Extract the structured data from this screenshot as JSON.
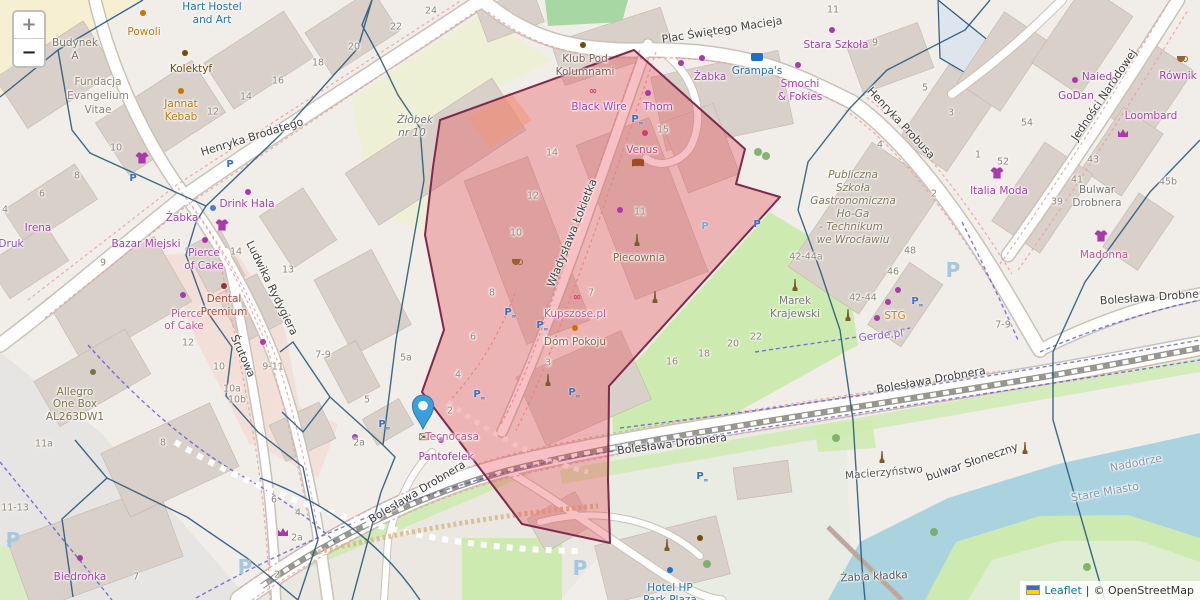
{
  "controls": {
    "zoom_in": "+",
    "zoom_out": "−"
  },
  "attribution": {
    "leaflet": "Leaflet",
    "separator": "|",
    "osm": "© OpenStreetMap"
  },
  "overlay": {
    "fill": "rgba(229,58,70,0.32)",
    "stroke": "#7e2a4d"
  },
  "marker": {
    "x": 423,
    "y": 434
  },
  "map_labels": [
    {
      "t": "Henryka Brodatego",
      "x": 252,
      "y": 137,
      "r": -17,
      "c": "#3f3f3f",
      "s": 11
    },
    {
      "t": "Plac Świętego Macieja",
      "x": 722,
      "y": 30,
      "r": -9,
      "c": "#3f3f3f",
      "s": 11
    },
    {
      "t": "Henryka Probusa",
      "x": 901,
      "y": 123,
      "r": 47,
      "c": "#3f3f3f",
      "s": 11
    },
    {
      "t": "Jedności Narodowej",
      "x": 1104,
      "y": 95,
      "r": -56,
      "c": "#3f3f3f",
      "s": 11
    },
    {
      "t": "Ludwika Rydygiera",
      "x": 272,
      "y": 288,
      "r": 64,
      "c": "#3f3f3f",
      "s": 11
    },
    {
      "t": "Śrutowa",
      "x": 243,
      "y": 356,
      "r": 66,
      "c": "#3f3f3f",
      "s": 11
    },
    {
      "t": "Władysława Łokietka",
      "x": 572,
      "y": 233,
      "r": -68,
      "c": "#3f3f3f",
      "s": 11
    },
    {
      "t": "Bolesława Drobnera",
      "x": 417,
      "y": 492,
      "r": -31,
      "c": "#3f3f3f",
      "s": 11
    },
    {
      "t": "Bolesława Drobnera",
      "x": 672,
      "y": 444,
      "r": -7,
      "c": "#3f3f3f",
      "s": 11
    },
    {
      "t": "Bolesława Drobnera",
      "x": 931,
      "y": 380,
      "r": -10,
      "c": "#3f3f3f",
      "s": 11
    },
    {
      "t": "Bolesława Drobnera",
      "x": 1155,
      "y": 297,
      "r": -4,
      "c": "#3f3f3f",
      "s": 11
    },
    {
      "t": "bulwar Słoneczny",
      "x": 972,
      "y": 462,
      "r": -19,
      "c": "#3f3f3f",
      "s": 11
    },
    {
      "t": "Żabia kładka",
      "x": 874,
      "y": 577,
      "r": -3,
      "c": "#555555",
      "s": 10.5
    },
    {
      "t": "Nadodrze",
      "x": 1136,
      "y": 463,
      "r": -11,
      "c": "#8795a8",
      "s": 11
    },
    {
      "t": "Stare Miasto",
      "x": 1105,
      "y": 492,
      "r": -10,
      "c": "#8795a8",
      "s": 11
    },
    {
      "t": "Macierzyństwo",
      "x": 884,
      "y": 473,
      "r": -5,
      "c": "#555555",
      "s": 10.5
    },
    {
      "t": "Budynek",
      "x": 75,
      "y": 43,
      "c": "#7a7467"
    },
    {
      "t": "A",
      "x": 75,
      "y": 56,
      "c": "#7a7467"
    },
    {
      "t": "Fundacja",
      "x": 98,
      "y": 82,
      "c": "#8c8370"
    },
    {
      "t": "Evangelium",
      "x": 98,
      "y": 96,
      "c": "#8c8370"
    },
    {
      "t": "Vitae",
      "x": 98,
      "y": 110,
      "c": "#8c8370"
    },
    {
      "t": "Hart Hostel",
      "x": 212,
      "y": 7,
      "c": "#1d70c6"
    },
    {
      "t": "and Art",
      "x": 212,
      "y": 20,
      "c": "#1d70c6"
    },
    {
      "t": "Żłobek",
      "x": 415,
      "y": 120,
      "c": "#777777",
      "i": true
    },
    {
      "t": "nr 10",
      "x": 412,
      "y": 133,
      "c": "#777777",
      "i": true
    },
    {
      "t": "Klub Pod",
      "x": 585,
      "y": 59,
      "c": "#7d6052"
    },
    {
      "t": "Kolumnami",
      "x": 585,
      "y": 72,
      "c": "#7d6052"
    },
    {
      "t": "Publiczna",
      "x": 853,
      "y": 175,
      "c": "#7e7a58",
      "i": true
    },
    {
      "t": "Szkoła",
      "x": 853,
      "y": 188,
      "c": "#7e7a58",
      "i": true
    },
    {
      "t": "Gastronomiczna",
      "x": 853,
      "y": 201,
      "c": "#7e7a58",
      "i": true
    },
    {
      "t": "Ho-Ga",
      "x": 853,
      "y": 214,
      "c": "#7e7a58",
      "i": true
    },
    {
      "t": "- Technikum",
      "x": 851,
      "y": 227,
      "c": "#7e7a58",
      "i": true
    },
    {
      "t": "we Wrocławiu",
      "x": 853,
      "y": 240,
      "c": "#7e7a58",
      "i": true
    },
    {
      "t": "Marek",
      "x": 795,
      "y": 301,
      "c": "#777777"
    },
    {
      "t": "Krajewski",
      "x": 795,
      "y": 314,
      "c": "#777777"
    },
    {
      "t": "Bulwar",
      "x": 1097,
      "y": 190,
      "c": "#777777"
    },
    {
      "t": "Drobnera",
      "x": 1097,
      "y": 203,
      "c": "#777777"
    },
    {
      "t": "Hotel HP",
      "x": 670,
      "y": 588,
      "c": "#1d70c6"
    },
    {
      "t": "Park Plaza",
      "x": 670,
      "y": 600,
      "c": "#1d70c6"
    },
    {
      "t": "Powoli",
      "x": 144,
      "y": 32,
      "c": "#c77400"
    },
    {
      "t": "Kolektyf",
      "x": 191,
      "y": 69,
      "c": "#734a08"
    },
    {
      "t": "Jannat",
      "x": 181,
      "y": 104,
      "c": "#c77400"
    },
    {
      "t": "Kebab",
      "x": 181,
      "y": 117,
      "c": "#c77400"
    },
    {
      "t": "Irena",
      "x": 38,
      "y": 228,
      "c": "#ac39ac"
    },
    {
      "t": "Druk",
      "x": 11,
      "y": 244,
      "c": "#8a4fc8"
    },
    {
      "t": "Żabka",
      "x": 182,
      "y": 218,
      "c": "#ac39ac"
    },
    {
      "t": "Żabka",
      "x": 710,
      "y": 77,
      "c": "#ac39ac"
    },
    {
      "t": "Bazar Miejski",
      "x": 146,
      "y": 244,
      "c": "#ac39ac"
    },
    {
      "t": "Drink Hala",
      "x": 247,
      "y": 204,
      "c": "#ac39ac"
    },
    {
      "t": "Pierce",
      "x": 204,
      "y": 253,
      "c": "#ac39ac"
    },
    {
      "t": "of Cake",
      "x": 204,
      "y": 266,
      "c": "#ac39ac"
    },
    {
      "t": "Pierce",
      "x": 187,
      "y": 314,
      "c": "#d14f87"
    },
    {
      "t": "of Cake",
      "x": 184,
      "y": 326,
      "c": "#d14f87"
    },
    {
      "t": "Dental",
      "x": 224,
      "y": 299,
      "c": "#c0392b"
    },
    {
      "t": "Premium",
      "x": 224,
      "y": 312,
      "c": "#c0392b"
    },
    {
      "t": "Allegro",
      "x": 75,
      "y": 392,
      "c": "#7d7145"
    },
    {
      "t": "One Box",
      "x": 75,
      "y": 404,
      "c": "#7d7145"
    },
    {
      "t": "AL263DW1",
      "x": 75,
      "y": 417,
      "c": "#7d7145"
    },
    {
      "t": "Biedronka",
      "x": 80,
      "y": 577,
      "c": "#ac39ac"
    },
    {
      "t": "Black Wire",
      "x": 599,
      "y": 107,
      "c": "#ac39ac"
    },
    {
      "t": "Thom",
      "x": 658,
      "y": 107,
      "c": "#ac39ac"
    },
    {
      "t": "Venus",
      "x": 642,
      "y": 150,
      "c": "#d63970"
    },
    {
      "t": "Grampa's",
      "x": 757,
      "y": 71,
      "c": "#1d70c6"
    },
    {
      "t": "Smochi",
      "x": 800,
      "y": 84,
      "c": "#ac39ac"
    },
    {
      "t": "& Fokies",
      "x": 800,
      "y": 97,
      "c": "#ac39ac"
    },
    {
      "t": "Stara Szkoła",
      "x": 836,
      "y": 45,
      "c": "#ac39ac"
    },
    {
      "t": "Piecownia",
      "x": 639,
      "y": 258,
      "c": "#8a6248"
    },
    {
      "t": "Kupszose.pl",
      "x": 575,
      "y": 314,
      "c": "#d14f87"
    },
    {
      "t": "Dom Pokoju",
      "x": 575,
      "y": 342,
      "c": "#8a6248"
    },
    {
      "t": "Tecnocasa",
      "x": 452,
      "y": 437,
      "c": "#d14f87"
    },
    {
      "t": "Pantofelek",
      "x": 446,
      "y": 457,
      "c": "#ac39ac"
    },
    {
      "t": "Italia Moda",
      "x": 999,
      "y": 191,
      "c": "#ac39ac"
    },
    {
      "t": "Madonna",
      "x": 1104,
      "y": 255,
      "c": "#d14f87"
    },
    {
      "t": "Naied",
      "x": 1097,
      "y": 77,
      "c": "#ac39ac"
    },
    {
      "t": "GoDan",
      "x": 1076,
      "y": 96,
      "c": "#ac39ac"
    },
    {
      "t": "Równik",
      "x": 1178,
      "y": 76,
      "c": "#ac39ac"
    },
    {
      "t": "Loombard",
      "x": 1151,
      "y": 116,
      "c": "#ac39ac"
    },
    {
      "t": "Gerde.pl",
      "x": 881,
      "y": 336,
      "r": -6,
      "c": "#8d5fc9"
    },
    {
      "t": "STG",
      "x": 895,
      "y": 316,
      "c": "#c97b2e"
    },
    {
      "t": "16",
      "x": 278,
      "y": 81,
      "c": "#8f8779",
      "s": 9.5
    },
    {
      "t": "14",
      "x": 246,
      "y": 97,
      "c": "#8f8779",
      "s": 9.5
    },
    {
      "t": "12",
      "x": 213,
      "y": 112,
      "c": "#8f8779",
      "s": 9.5
    },
    {
      "t": "10",
      "x": 116,
      "y": 148,
      "c": "#8f8779",
      "s": 9.5
    },
    {
      "t": "8",
      "x": 77,
      "y": 176,
      "c": "#8f8779",
      "s": 9.5
    },
    {
      "t": "6",
      "x": 42,
      "y": 194,
      "c": "#8f8779",
      "s": 9.5
    },
    {
      "t": "4",
      "x": 5,
      "y": 210,
      "c": "#8f8779",
      "s": 9.5
    },
    {
      "t": "24",
      "x": 431,
      "y": 11,
      "c": "#8f8779",
      "s": 9.5
    },
    {
      "t": "22",
      "x": 396,
      "y": 27,
      "c": "#8f8779",
      "s": 9.5
    },
    {
      "t": "20",
      "x": 354,
      "y": 47,
      "c": "#8f8779",
      "s": 9.5
    },
    {
      "t": "18",
      "x": 318,
      "y": 63,
      "c": "#8f8779",
      "s": 9.5
    },
    {
      "t": "9",
      "x": 103,
      "y": 263,
      "c": "#8f8779",
      "s": 9.5
    },
    {
      "t": "14",
      "x": 236,
      "y": 252,
      "c": "#8f8779",
      "s": 9.5
    },
    {
      "t": "13",
      "x": 288,
      "y": 270,
      "c": "#8f8779",
      "s": 9.5
    },
    {
      "t": "12",
      "x": 188,
      "y": 343,
      "c": "#8f8779",
      "s": 9.5
    },
    {
      "t": "10",
      "x": 219,
      "y": 367,
      "c": "#8f8779",
      "s": 9.5
    },
    {
      "t": "10a",
      "x": 232,
      "y": 389,
      "c": "#8f8779",
      "s": 9.5
    },
    {
      "t": "10b",
      "x": 237,
      "y": 400,
      "c": "#8f8779",
      "s": 9.5
    },
    {
      "t": "9-11",
      "x": 273,
      "y": 367,
      "c": "#8f8779",
      "s": 9.5
    },
    {
      "t": "7-9",
      "x": 323,
      "y": 355,
      "c": "#8f8779",
      "s": 9.5
    },
    {
      "t": "5a",
      "x": 406,
      "y": 358,
      "c": "#8f8779",
      "s": 9.5
    },
    {
      "t": "5",
      "x": 367,
      "y": 400,
      "c": "#8f8779",
      "s": 9.5
    },
    {
      "t": "2a",
      "x": 359,
      "y": 443,
      "c": "#8f8779",
      "s": 9.5
    },
    {
      "t": "11-13",
      "x": 15,
      "y": 508,
      "c": "#8f8779",
      "s": 9.5
    },
    {
      "t": "11a",
      "x": 44,
      "y": 444,
      "c": "#8f8779",
      "s": 9.5
    },
    {
      "t": "8",
      "x": 163,
      "y": 443,
      "c": "#8f8779",
      "s": 9.5
    },
    {
      "t": "7",
      "x": 136,
      "y": 577,
      "c": "#8f8779",
      "s": 9.5
    },
    {
      "t": "6",
      "x": 274,
      "y": 500,
      "c": "#8f8779",
      "s": 9.5
    },
    {
      "t": "4",
      "x": 298,
      "y": 513,
      "c": "#8f8779",
      "s": 9.5
    },
    {
      "t": "2a",
      "x": 297,
      "y": 538,
      "c": "#8f8779",
      "s": 9.5
    },
    {
      "t": "2",
      "x": 277,
      "y": 575,
      "c": "#8f8779",
      "s": 9.5
    },
    {
      "t": "14",
      "x": 552,
      "y": 153,
      "c": "#8f8779",
      "s": 9.5
    },
    {
      "t": "12",
      "x": 533,
      "y": 196,
      "c": "#8f8779",
      "s": 9.5
    },
    {
      "t": "15",
      "x": 663,
      "y": 130,
      "c": "#8f8779",
      "s": 9.5
    },
    {
      "t": "11",
      "x": 640,
      "y": 212,
      "c": "#8f8779",
      "s": 9.5
    },
    {
      "t": "10",
      "x": 516,
      "y": 233,
      "c": "#8f8779",
      "s": 9.5
    },
    {
      "t": "8",
      "x": 492,
      "y": 293,
      "c": "#8f8779",
      "s": 9.5
    },
    {
      "t": "7",
      "x": 591,
      "y": 293,
      "c": "#8f8779",
      "s": 9.5
    },
    {
      "t": "6",
      "x": 473,
      "y": 337,
      "c": "#8f8779",
      "s": 9.5
    },
    {
      "t": "4",
      "x": 458,
      "y": 375,
      "c": "#8f8779",
      "s": 9.5
    },
    {
      "t": "3",
      "x": 548,
      "y": 363,
      "c": "#8f8779",
      "s": 9.5
    },
    {
      "t": "2",
      "x": 450,
      "y": 411,
      "c": "#8f8779",
      "s": 9.5
    },
    {
      "t": "16",
      "x": 672,
      "y": 362,
      "c": "#8f8779",
      "s": 9.5
    },
    {
      "t": "18",
      "x": 704,
      "y": 354,
      "c": "#8f8779",
      "s": 9.5
    },
    {
      "t": "20",
      "x": 733,
      "y": 344,
      "c": "#8f8779",
      "s": 9.5
    },
    {
      "t": "22",
      "x": 756,
      "y": 337,
      "c": "#8f8779",
      "s": 9.5
    },
    {
      "t": "11",
      "x": 833,
      "y": 10,
      "c": "#8f8779",
      "s": 9.5
    },
    {
      "t": "9",
      "x": 875,
      "y": 43,
      "c": "#8f8779",
      "s": 9.5
    },
    {
      "t": "5",
      "x": 925,
      "y": 88,
      "c": "#8f8779",
      "s": 9.5
    },
    {
      "t": "3",
      "x": 951,
      "y": 113,
      "c": "#8f8779",
      "s": 9.5
    },
    {
      "t": "4",
      "x": 880,
      "y": 145,
      "c": "#8f8779",
      "s": 9.5
    },
    {
      "t": "2",
      "x": 934,
      "y": 194,
      "c": "#8f8779",
      "s": 9.5
    },
    {
      "t": "42-44a",
      "x": 806,
      "y": 257,
      "c": "#8f8779",
      "s": 9.5
    },
    {
      "t": "48",
      "x": 910,
      "y": 251,
      "c": "#8f8779",
      "s": 9.5
    },
    {
      "t": "46",
      "x": 893,
      "y": 272,
      "c": "#8f8779",
      "s": 9.5
    },
    {
      "t": "42-44",
      "x": 863,
      "y": 298,
      "c": "#8f8779",
      "s": 9.5
    },
    {
      "t": "7-9",
      "x": 1003,
      "y": 325,
      "c": "#8f8779",
      "s": 9.5
    },
    {
      "t": "52",
      "x": 1003,
      "y": 162,
      "c": "#8f8779",
      "s": 9.5
    },
    {
      "t": "1",
      "x": 978,
      "y": 155,
      "c": "#8f8779",
      "s": 9.5
    },
    {
      "t": "43",
      "x": 1093,
      "y": 160,
      "c": "#8f8779",
      "s": 9.5
    },
    {
      "t": "41",
      "x": 1077,
      "y": 180,
      "c": "#8f8779",
      "s": 9.5
    },
    {
      "t": "39",
      "x": 1057,
      "y": 202,
      "c": "#8f8779",
      "s": 9.5
    },
    {
      "t": "45b",
      "x": 1168,
      "y": 182,
      "c": "#8f8779",
      "s": 9.5
    },
    {
      "t": "54",
      "x": 1027,
      "y": 123,
      "c": "#8f8779",
      "s": 9.5
    }
  ],
  "map_icons": [
    {
      "k": "p",
      "x": 133,
      "y": 179
    },
    {
      "k": "p",
      "x": 230,
      "y": 165
    },
    {
      "k": "p",
      "x": 705,
      "y": 227,
      "c": "#7ba7d4"
    },
    {
      "k": "p",
      "x": 757,
      "y": 225
    },
    {
      "k": "pbike",
      "x": 508,
      "y": 313
    },
    {
      "k": "pbike",
      "x": 540,
      "y": 326
    },
    {
      "k": "pbike",
      "x": 572,
      "y": 393
    },
    {
      "k": "pbike",
      "x": 477,
      "y": 395
    },
    {
      "k": "pbike",
      "x": 635,
      "y": 120
    },
    {
      "k": "pbike",
      "x": 382,
      "y": 425
    },
    {
      "k": "pbike",
      "x": 915,
      "y": 302
    },
    {
      "k": "pbike",
      "x": 700,
      "y": 477
    },
    {
      "k": "P",
      "x": 245,
      "y": 567
    },
    {
      "k": "P",
      "x": 580,
      "y": 568
    },
    {
      "k": "P",
      "x": 953,
      "y": 270
    },
    {
      "k": "P",
      "x": 13,
      "y": 540
    },
    {
      "k": "shirt",
      "x": 142,
      "y": 158
    },
    {
      "k": "shirt",
      "x": 222,
      "y": 225
    },
    {
      "k": "shirt",
      "x": 997,
      "y": 173
    },
    {
      "k": "shirt",
      "x": 1101,
      "y": 236
    },
    {
      "k": "mail",
      "x": 424,
      "y": 438
    },
    {
      "k": "dot",
      "x": 648,
      "y": 93
    },
    {
      "k": "dot",
      "x": 620,
      "y": 210
    },
    {
      "k": "dot",
      "x": 183,
      "y": 295
    },
    {
      "k": "dot",
      "x": 888,
      "y": 302
    },
    {
      "k": "dot",
      "x": 877,
      "y": 318
    },
    {
      "k": "dot",
      "x": 1075,
      "y": 80
    },
    {
      "k": "dot",
      "x": 355,
      "y": 437
    },
    {
      "k": "dot",
      "x": 80,
      "y": 558
    },
    {
      "k": "dot",
      "x": 205,
      "y": 240
    },
    {
      "k": "dot",
      "x": 263,
      "y": 342
    },
    {
      "k": "dot",
      "x": 441,
      "y": 440
    },
    {
      "k": "dot",
      "x": 898,
      "y": 290
    },
    {
      "k": "dot",
      "x": 248,
      "y": 192
    },
    {
      "k": "dot",
      "x": 681,
      "y": 63
    },
    {
      "k": "dot",
      "x": 702,
      "y": 58
    },
    {
      "k": "dot",
      "x": 798,
      "y": 65
    },
    {
      "k": "dot",
      "x": 832,
      "y": 30
    },
    {
      "k": "dot",
      "x": 670,
      "y": 570,
      "c": "#1d70c6"
    },
    {
      "k": "dot",
      "x": 645,
      "y": 133,
      "c": "#d63970"
    },
    {
      "k": "dot",
      "x": 575,
      "y": 328,
      "c": "#c77400"
    },
    {
      "k": "dot",
      "x": 181,
      "y": 91,
      "c": "#c77400"
    },
    {
      "k": "dot",
      "x": 143,
      "y": 13,
      "c": "#c77400"
    },
    {
      "k": "dot",
      "x": 185,
      "y": 53,
      "c": "#734a08"
    },
    {
      "k": "dot",
      "x": 583,
      "y": 45,
      "c": "#734a08"
    },
    {
      "k": "dot",
      "x": 700,
      "y": 538,
      "c": "#734a08"
    },
    {
      "k": "dot",
      "x": 224,
      "y": 286,
      "c": "#a03030"
    },
    {
      "k": "dot",
      "x": 213,
      "y": 208,
      "c": "#4a7fc1"
    },
    {
      "k": "dot",
      "x": 93,
      "y": 372,
      "c": "#7d7145"
    },
    {
      "k": "obelisk",
      "x": 637,
      "y": 240
    },
    {
      "k": "obelisk",
      "x": 655,
      "y": 297
    },
    {
      "k": "obelisk",
      "x": 548,
      "y": 380
    },
    {
      "k": "obelisk",
      "x": 795,
      "y": 285
    },
    {
      "k": "obelisk",
      "x": 848,
      "y": 315
    },
    {
      "k": "obelisk",
      "x": 882,
      "y": 457
    },
    {
      "k": "obelisk",
      "x": 1025,
      "y": 448
    },
    {
      "k": "obelisk",
      "x": 667,
      "y": 545
    },
    {
      "k": "book",
      "x": 638,
      "y": 163
    },
    {
      "k": "bike",
      "x": 593,
      "y": 92
    },
    {
      "k": "bike",
      "x": 577,
      "y": 298
    },
    {
      "k": "cup",
      "x": 516,
      "y": 262
    },
    {
      "k": "cup",
      "x": 1181,
      "y": 59
    },
    {
      "k": "crown",
      "x": 283,
      "y": 532
    },
    {
      "k": "crown",
      "x": 1123,
      "y": 133
    },
    {
      "k": "tree",
      "x": 758,
      "y": 152
    },
    {
      "k": "tree",
      "x": 766,
      "y": 156
    },
    {
      "k": "tree",
      "x": 836,
      "y": 438
    },
    {
      "k": "tree",
      "x": 934,
      "y": 532
    },
    {
      "k": "tree",
      "x": 1087,
      "y": 567
    },
    {
      "k": "tree",
      "x": 707,
      "y": 564
    },
    {
      "k": "bunk",
      "x": 757,
      "y": 57
    }
  ]
}
